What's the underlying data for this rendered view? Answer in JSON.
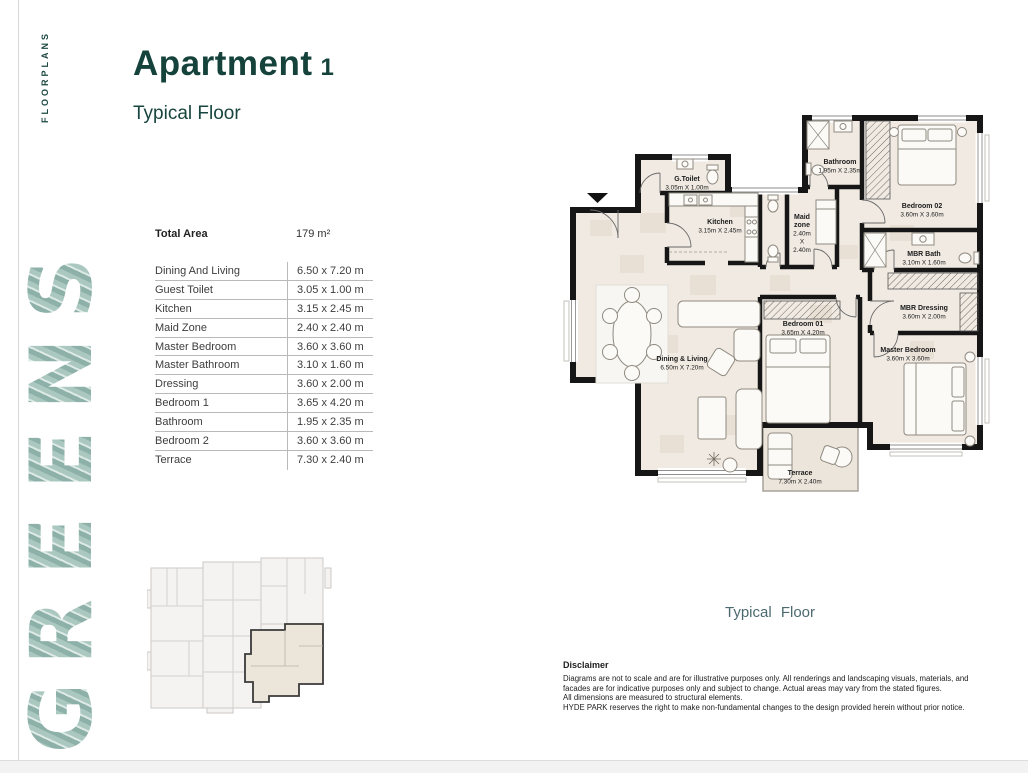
{
  "brand": {
    "floorplans": "FLOORPLANS",
    "name": "GREENS",
    "letters": [
      "S",
      "N",
      "E",
      "E",
      "R",
      "G"
    ],
    "logo_color": "#a2c1b9"
  },
  "header": {
    "title": "Apartment",
    "number": "1",
    "subtitle": "Typical Floor",
    "accent_color": "#15433c"
  },
  "spec_table": {
    "total_area_label": "Total Area",
    "total_area_value": "179 m²",
    "rows": [
      {
        "label": "Dining And Living",
        "value": "6.50 x 7.20 m"
      },
      {
        "label": "Guest Toilet",
        "value": "3.05 x 1.00 m"
      },
      {
        "label": "Kitchen",
        "value": "3.15 x 2.45 m"
      },
      {
        "label": "Maid Zone",
        "value": "2.40 x 2.40 m"
      },
      {
        "label": "Master Bedroom",
        "value": "3.60 x 3.60 m"
      },
      {
        "label": "Master Bathroom",
        "value": "3.10 x 1.60 m"
      },
      {
        "label": "Dressing",
        "value": "3.60 x 2.00 m"
      },
      {
        "label": "Bedroom 1",
        "value": "3.65 x 4.20 m"
      },
      {
        "label": "Bathroom",
        "value": "1.95 x 2.35 m"
      },
      {
        "label": "Bedroom 2",
        "value": "3.60 x 3.60 m"
      },
      {
        "label": "Terrace",
        "value": "7.30 x 2.40 m"
      }
    ]
  },
  "plan": {
    "caption": "Typical Floor",
    "caption_color": "#4c6a70",
    "wall_color": "#161616",
    "floor_color": "#f0eae2",
    "rooms": {
      "g_toilet": {
        "name": "G.Toilet",
        "dims": "3.05m X 1.00m"
      },
      "kitchen": {
        "name": "Kitchen",
        "dims": "3.15m X 2.45m"
      },
      "maid": {
        "lines": [
          "Maid",
          "zone",
          "2.40m",
          "X",
          "2.40m"
        ]
      },
      "bathroom": {
        "name": "Bathroom",
        "dims": "1.95m X 2.35m"
      },
      "bedroom02": {
        "name": "Bedroom 02",
        "dims": "3.60m X 3.60m"
      },
      "mbr_bath": {
        "name": "MBR Bath",
        "dims": "3.10m X 1.60m"
      },
      "mbr_dressing": {
        "name": "MBR Dressing",
        "dims": "3.60m X 2.00m"
      },
      "bedroom01": {
        "name": "Bedroom 01",
        "dims": "3.65m X 4.20m"
      },
      "master": {
        "name": "Master Bedroom",
        "dims": "3.60m X 3.60m"
      },
      "dining": {
        "name": "Dining & Living",
        "dims": "6.50m X 7.20m"
      },
      "terrace": {
        "name": "Terrace",
        "dims": "7.30m X 2.40m"
      }
    }
  },
  "disclaimer": {
    "title": "Disclaimer",
    "lines": [
      "Diagrams are not to scale and are for illustrative purposes only. All renderings and landscaping visuals, materials, and",
      "facades are for indicative purposes only and subject to change. Actual areas may vary from the stated figures.",
      "All dimensions are measured to structural elements.",
      "HYDE PARK reserves the right to make non-fundamental changes to the design provided herein without prior notice."
    ]
  }
}
